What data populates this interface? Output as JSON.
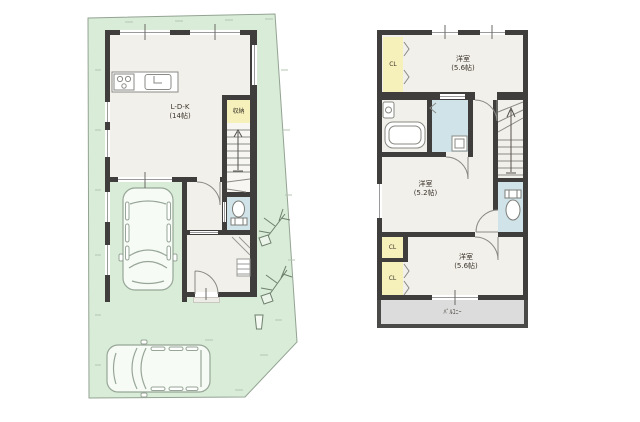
{
  "plans": {
    "floor1": {
      "ldk": {
        "label": "L-D-K",
        "size": "(14帖)"
      },
      "storage": {
        "label": "収納"
      }
    },
    "floor2": {
      "rooms": [
        {
          "label": "洋室",
          "size": "(5.6帖)"
        },
        {
          "label": "洋室",
          "size": "(5.2帖)"
        },
        {
          "label": "洋室",
          "size": "(5.6帖)"
        }
      ],
      "closets": [
        {
          "label": "CL"
        },
        {
          "label": "CL"
        },
        {
          "label": "CL"
        }
      ],
      "balcony": {
        "label": "ﾊﾞﾙｺﾆｰ"
      }
    }
  },
  "colors": {
    "wall": "#3f3e3c",
    "floor": "#f2f0ea",
    "site_green": "#d8ecd7",
    "closet_yellow": "#f6f1ba",
    "wet_area_blue": "#cfe3e9",
    "balcony_gray": "#dcdcdc"
  }
}
